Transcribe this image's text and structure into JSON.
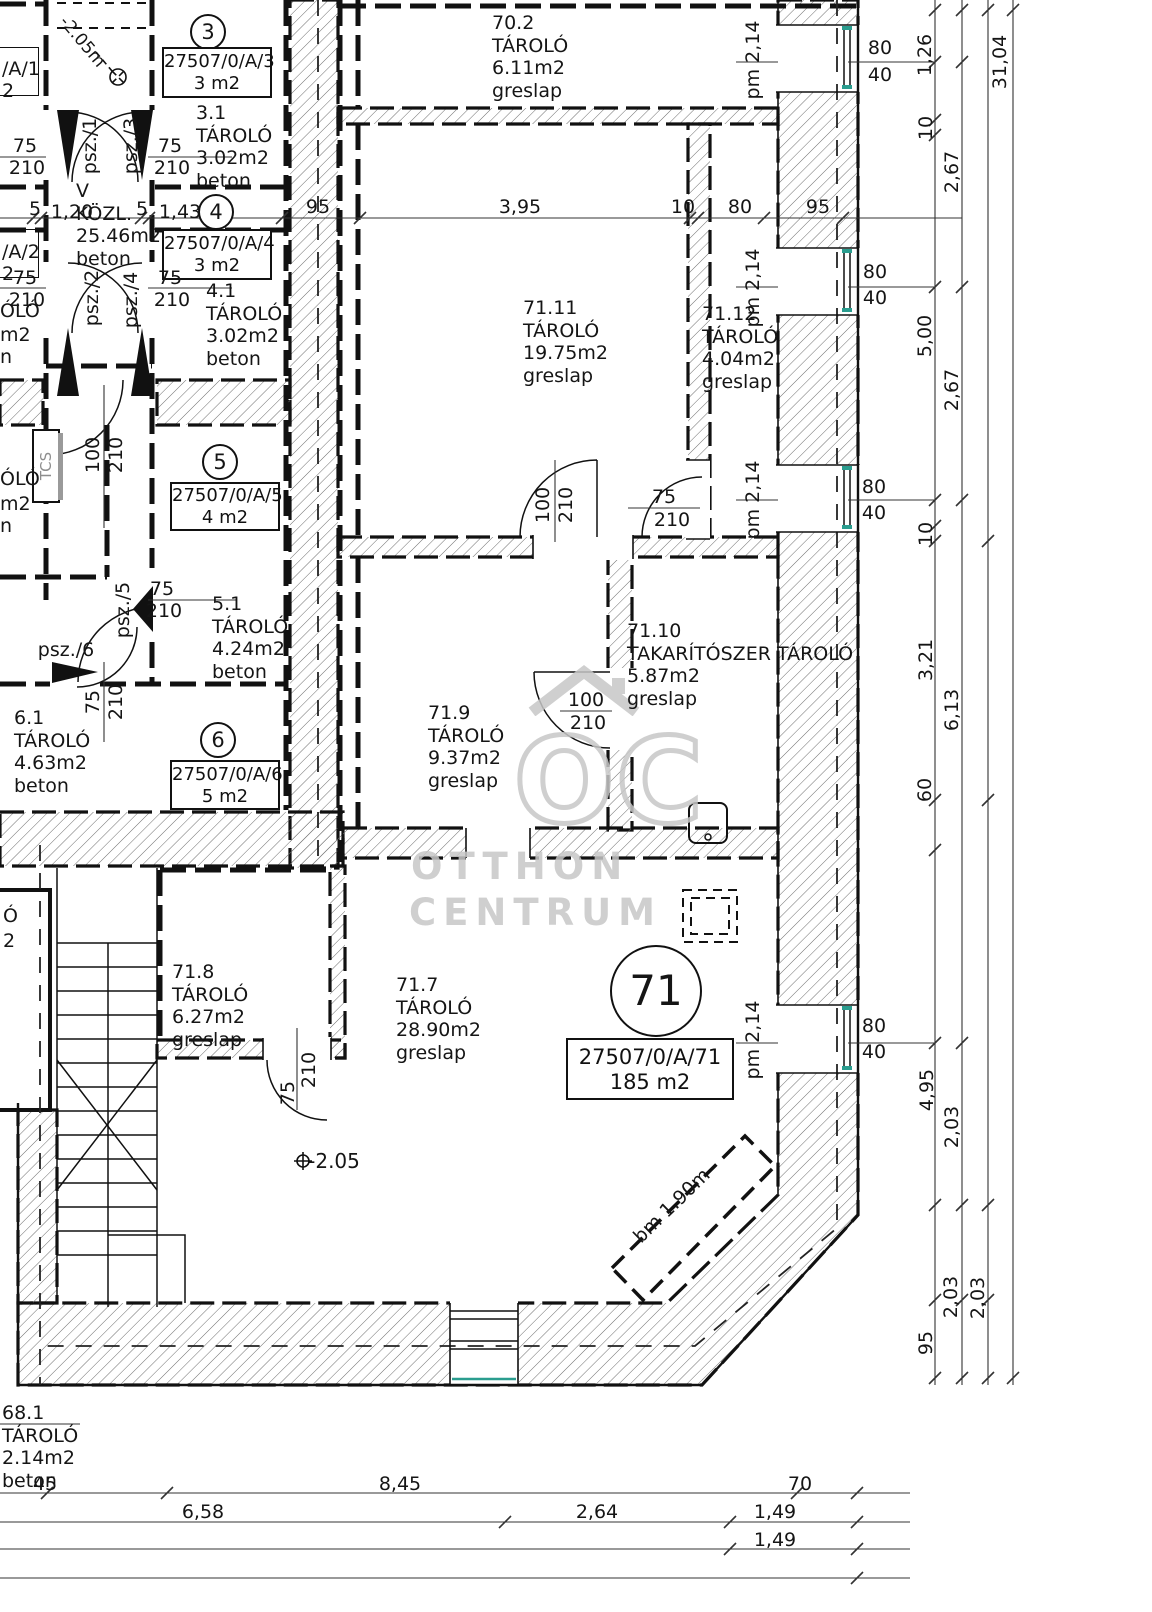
{
  "watermark": {
    "monogram": "OC",
    "line1": "OTTHON",
    "line2": "CENTRUM"
  },
  "room_labels": [
    {
      "n": "room-70-2",
      "x": 492,
      "y": 12,
      "lines": [
        "70.2",
        "TÁROLÓ",
        "6.11m2",
        "greslap"
      ]
    },
    {
      "n": "room-71-11",
      "x": 523,
      "y": 297,
      "lines": [
        "71.11",
        "TÁROLÓ",
        "19.75m2",
        "greslap"
      ]
    },
    {
      "n": "room-71-12",
      "x": 702,
      "y": 303,
      "lines": [
        "71.12",
        "TÁROLÓ",
        "4.04m2",
        "greslap"
      ]
    },
    {
      "n": "room-71-9",
      "x": 428,
      "y": 702,
      "lines": [
        "71.9",
        "TÁROLÓ",
        "9.37m2",
        "greslap"
      ]
    },
    {
      "n": "room-71-10",
      "x": 627,
      "y": 620,
      "lines": [
        "71.10",
        "TAKARÍTÓSZER TÁROLÓ",
        "5.87m2",
        "greslap"
      ]
    },
    {
      "n": "room-71-8",
      "x": 172,
      "y": 961,
      "lines": [
        "71.8",
        "TÁROLÓ",
        "6.27m2",
        "greslap"
      ]
    },
    {
      "n": "room-71-7",
      "x": 396,
      "y": 974,
      "lines": [
        "71.7",
        "TÁROLÓ",
        "28.90m2",
        "greslap"
      ]
    },
    {
      "n": "room-3-1",
      "x": 196,
      "y": 102,
      "lines": [
        "3.1",
        "TÁROLÓ",
        "3.02m2",
        "beton"
      ]
    },
    {
      "n": "room-4-1",
      "x": 206,
      "y": 280,
      "lines": [
        "4.1",
        "TÁROLÓ",
        "3.02m2",
        "beton"
      ]
    },
    {
      "n": "room-5-1",
      "x": 212,
      "y": 593,
      "lines": [
        "5.1",
        "TÁROLÓ",
        "4.24m2",
        "beton"
      ]
    },
    {
      "n": "room-6-1",
      "x": 14,
      "y": 707,
      "lines": [
        "6.1",
        "TÁROLÓ",
        "4.63m2",
        "beton"
      ]
    },
    {
      "n": "room-kozl",
      "x": 76,
      "y": 180,
      "lines": [
        "V",
        "KÖZL.",
        "25.46m2",
        "beton"
      ]
    },
    {
      "n": "room-68-1",
      "x": 2,
      "y": 1402,
      "lines": [
        "68.1",
        "TÁROLÓ",
        "2.14m2",
        "beton"
      ]
    }
  ],
  "units": [
    {
      "number": "3",
      "parcel": "27507/0/A/3",
      "size": "3 m2",
      "circle": {
        "cx": 208,
        "cy": 32,
        "r": 16
      },
      "box": {
        "x": 162,
        "y": 47,
        "w": 106,
        "h": 47
      }
    },
    {
      "number": "4",
      "parcel": "27507/0/A/4",
      "size": "3 m2",
      "circle": {
        "cx": 216,
        "cy": 212,
        "r": 16
      },
      "box": {
        "x": 162,
        "y": 229,
        "w": 106,
        "h": 47
      }
    },
    {
      "number": "5",
      "parcel": "27507/0/A/5",
      "size": "4 m2",
      "circle": {
        "cx": 220,
        "cy": 462,
        "r": 16
      },
      "box": {
        "x": 170,
        "y": 482,
        "w": 106,
        "h": 45
      }
    },
    {
      "number": "6",
      "parcel": "27507/0/A/6",
      "size": "5 m2",
      "circle": {
        "cx": 218,
        "cy": 740,
        "r": 16
      },
      "box": {
        "x": 170,
        "y": 760,
        "w": 106,
        "h": 46
      }
    },
    {
      "number": "71",
      "parcel": "27507/0/A/71",
      "size": "185 m2",
      "circle": {
        "cx": 656,
        "cy": 991,
        "r": 44
      },
      "box": {
        "x": 566,
        "y": 1038,
        "w": 164,
        "h": 58
      }
    }
  ],
  "door_labels": [
    {
      "t": "psz./1",
      "x": 90,
      "y": 146,
      "rot": -90
    },
    {
      "t": "psz./3",
      "x": 131,
      "y": 146,
      "rot": -90
    },
    {
      "t": "psz./2",
      "x": 92,
      "y": 298,
      "rot": -90
    },
    {
      "t": "psz./4",
      "x": 131,
      "y": 300,
      "rot": -90
    },
    {
      "t": "psz./5",
      "x": 123,
      "y": 610,
      "rot": -90
    },
    {
      "t": "psz./6",
      "x": 66,
      "y": 650,
      "rot": 0
    }
  ],
  "dims": [
    {
      "t": "5",
      "x": 35,
      "y": 209
    },
    {
      "t": "1,20",
      "x": 72,
      "y": 212
    },
    {
      "t": "5",
      "x": 142,
      "y": 209
    },
    {
      "t": "1,43",
      "x": 180,
      "y": 212
    },
    {
      "t": "95",
      "x": 318,
      "y": 207
    },
    {
      "t": "3,95",
      "x": 520,
      "y": 207
    },
    {
      "t": "10",
      "x": 683,
      "y": 207
    },
    {
      "t": "80",
      "x": 740,
      "y": 207
    },
    {
      "t": "95",
      "x": 818,
      "y": 207
    },
    {
      "t": "75",
      "x": 25,
      "y": 146
    },
    {
      "t": "210",
      "x": 27,
      "y": 168
    },
    {
      "t": "75",
      "x": 170,
      "y": 146
    },
    {
      "t": "210",
      "x": 172,
      "y": 168
    },
    {
      "t": "75",
      "x": 25,
      "y": 278
    },
    {
      "t": "210",
      "x": 27,
      "y": 300
    },
    {
      "t": "75",
      "x": 170,
      "y": 278
    },
    {
      "t": "210",
      "x": 172,
      "y": 300
    },
    {
      "t": "75",
      "x": 162,
      "y": 589
    },
    {
      "t": "210",
      "x": 164,
      "y": 611
    },
    {
      "t": "75",
      "x": 93,
      "y": 702,
      "rot": -90
    },
    {
      "t": "210",
      "x": 116,
      "y": 702,
      "rot": -90
    },
    {
      "t": "100",
      "x": 93,
      "y": 455,
      "rot": -90
    },
    {
      "t": "210",
      "x": 116,
      "y": 455,
      "rot": -90
    },
    {
      "t": "100",
      "x": 543,
      "y": 505,
      "rot": -90
    },
    {
      "t": "210",
      "x": 566,
      "y": 505,
      "rot": -90
    },
    {
      "t": "100",
      "x": 586,
      "y": 700
    },
    {
      "t": "210",
      "x": 588,
      "y": 723
    },
    {
      "t": "75",
      "x": 664,
      "y": 497
    },
    {
      "t": "210",
      "x": 672,
      "y": 520
    },
    {
      "t": "75",
      "x": 288,
      "y": 1093,
      "rot": -90
    },
    {
      "t": "210",
      "x": 309,
      "y": 1070,
      "rot": -90
    },
    {
      "t": "80",
      "x": 880,
      "y": 48
    },
    {
      "t": "40",
      "x": 880,
      "y": 75
    },
    {
      "t": "80",
      "x": 875,
      "y": 272
    },
    {
      "t": "40",
      "x": 875,
      "y": 298
    },
    {
      "t": "80",
      "x": 874,
      "y": 487
    },
    {
      "t": "40",
      "x": 874,
      "y": 513
    },
    {
      "t": "80",
      "x": 874,
      "y": 1026
    },
    {
      "t": "40",
      "x": 874,
      "y": 1052
    },
    {
      "t": "1,26",
      "x": 925,
      "y": 55,
      "rot": -90
    },
    {
      "t": "10",
      "x": 926,
      "y": 128,
      "rot": -90
    },
    {
      "t": "5,00",
      "x": 925,
      "y": 336,
      "rot": -90
    },
    {
      "t": "10",
      "x": 926,
      "y": 534,
      "rot": -90
    },
    {
      "t": "3,21",
      "x": 926,
      "y": 660,
      "rot": -90
    },
    {
      "t": "60",
      "x": 925,
      "y": 790,
      "rot": -90
    },
    {
      "t": "4,95",
      "x": 927,
      "y": 1090,
      "rot": -90
    },
    {
      "t": "95",
      "x": 926,
      "y": 1343,
      "rot": -90
    },
    {
      "t": "2,67",
      "x": 952,
      "y": 172,
      "rot": -90
    },
    {
      "t": "2,67",
      "x": 952,
      "y": 390,
      "rot": -90
    },
    {
      "t": "6,13",
      "x": 952,
      "y": 710,
      "rot": -90
    },
    {
      "t": "2,03",
      "x": 952,
      "y": 1127,
      "rot": -90
    },
    {
      "t": "2,03",
      "x": 951,
      "y": 1297,
      "rot": -90
    },
    {
      "t": "2,03",
      "x": 978,
      "y": 1298,
      "rot": -90
    },
    {
      "t": "31,04",
      "x": 1000,
      "y": 62,
      "rot": -90
    },
    {
      "t": "45",
      "x": 45,
      "y": 1484
    },
    {
      "t": "8,45",
      "x": 400,
      "y": 1484
    },
    {
      "t": "70",
      "x": 800,
      "y": 1484
    },
    {
      "t": "6,58",
      "x": 203,
      "y": 1512
    },
    {
      "t": "2,64",
      "x": 597,
      "y": 1512
    },
    {
      "t": "1,49",
      "x": 775,
      "y": 1512
    },
    {
      "t": "1,49",
      "x": 775,
      "y": 1540
    }
  ],
  "annotations": [
    {
      "t": "-2.05m",
      "x": 82,
      "y": 42,
      "rot": 50,
      "size": 17
    },
    {
      "t": "-2.05",
      "x": 334,
      "y": 1161,
      "size": 20
    },
    {
      "t": "bm 1.90m",
      "x": 672,
      "y": 1206,
      "rot": -44
    },
    {
      "t": "TCS",
      "x": 46,
      "y": 466,
      "rot": -90,
      "size": 15,
      "color": "#8d8d8d"
    },
    {
      "t": "pm 2,14",
      "x": 753,
      "y": 60,
      "rot": -90
    },
    {
      "t": "pm 2,14",
      "x": 753,
      "y": 288,
      "rot": -90
    },
    {
      "t": "pm 2,14",
      "x": 753,
      "y": 500,
      "rot": -90
    },
    {
      "t": "pm 2,14",
      "x": 753,
      "y": 1040,
      "rot": -90
    }
  ],
  "cut_labels": [
    {
      "t": "/A/1",
      "x": 2,
      "y": 58
    },
    {
      "t": "2",
      "x": 2,
      "y": 80
    },
    {
      "t": "/A/2",
      "x": 2,
      "y": 241
    },
    {
      "t": "2",
      "x": 2,
      "y": 263
    },
    {
      "t": "ÓLÓ",
      "x": 0,
      "y": 300
    },
    {
      "t": "m2",
      "x": 0,
      "y": 324
    },
    {
      "t": "n",
      "x": 0,
      "y": 346
    },
    {
      "t": "ÓLÓ",
      "x": 0,
      "y": 468
    },
    {
      "t": "m2",
      "x": 0,
      "y": 493
    },
    {
      "t": "n",
      "x": 0,
      "y": 515
    },
    {
      "t": "Ó",
      "x": 3,
      "y": 905
    },
    {
      "t": "2",
      "x": 3,
      "y": 930
    }
  ]
}
